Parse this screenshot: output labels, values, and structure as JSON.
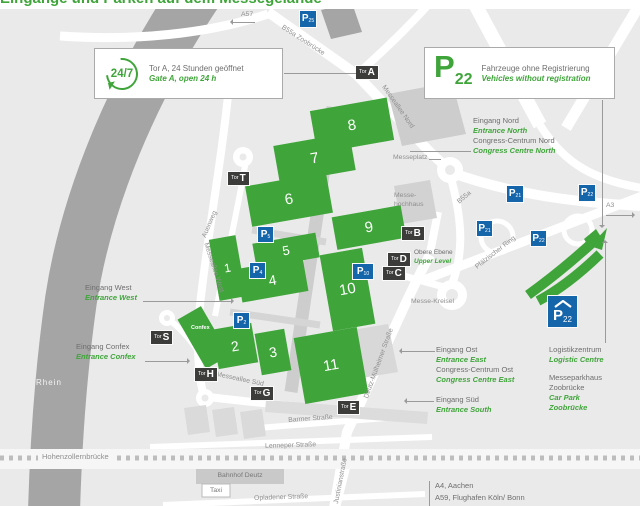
{
  "colors": {
    "green": "#3fa53a",
    "blue": "#1565ab",
    "dark_badge": "#3c3c3b",
    "map_bg": "#eaeaea",
    "river": "#a5a5a5",
    "gray_text": "#6e6e6e",
    "road_text": "#8f8f8f",
    "building": "#d5d5d5"
  },
  "heading": {
    "fragment": "Eingänge und Parken auf dem Messegelände"
  },
  "boxes": {
    "gate_a": {
      "badge": "24/7",
      "de": "Tor A, 24 Stunden geöffnet",
      "en": "Gate A, open 24 h"
    },
    "p22": {
      "p": "P",
      "sub": "22",
      "de": "Fahrzeuge ohne Registrierung",
      "en": "Vehicles without registration"
    }
  },
  "halls": {
    "h1": "1",
    "h2": "2",
    "h3": "3",
    "h4": "4",
    "h5": "5",
    "h6": "6",
    "h7": "7",
    "h8": "8",
    "h9": "9",
    "h10": "10",
    "h11": "11",
    "confex": "Confex"
  },
  "gates": {
    "prefix": "Tor",
    "a": "A",
    "t": "T",
    "b": "B",
    "d": "D",
    "c": "C",
    "s": "S",
    "h": "H",
    "g": "G",
    "e": "E"
  },
  "parking": {
    "p": "P",
    "p25": "25",
    "p21": "21",
    "p22": "22",
    "p5": "5",
    "p4": "4",
    "p2": "2",
    "p10": "10"
  },
  "entrances": {
    "west": {
      "de": "Eingang West",
      "en": "Entrance West"
    },
    "confex": {
      "de": "Eingang Confex",
      "en": "Entrance Confex"
    },
    "nord": {
      "de": "Eingang Nord",
      "en": "Entrance North",
      "de2": "Congress-Centrum Nord",
      "en2": "Congress Centre North"
    },
    "ost": {
      "de": "Eingang Ost",
      "en": "Entrance East",
      "de2": "Congress-Centrum Ost",
      "en2": "Congress Centre East"
    },
    "sued": {
      "de": "Eingang Süd",
      "en": "Entrance South"
    },
    "logistik": {
      "de": "Logistikzentrum",
      "en": "Logistic Centre"
    },
    "parkhaus": {
      "de1": "Messeparkhaus",
      "de2": "Zoobrücke",
      "en1": "Car Park",
      "en2": "Zoobrücke"
    }
  },
  "places": {
    "messeplatz": "Messeplatz",
    "hochhaus1": "Messe-",
    "hochhaus2": "hochhaus",
    "obere_de": "Obere Ebene",
    "obere_en": "Upper Level",
    "kreisel": "Messe-Kreisel",
    "rhein": "Rhein",
    "hohenzollernbruecke": "Hohenzollernbrücke",
    "bahnhof": "Bahnhof Deutz",
    "taxi": "Taxi"
  },
  "roads": {
    "a57": "A57",
    "a3": "A3",
    "b55a_zoo": "B55a Zoobrücke",
    "m_nord": "Messeallee Nord",
    "b55a": "B55a",
    "pf_ring": "Pfälzischer Ring",
    "dm_str": "Deutz-Mülheimer Straße",
    "auenweg": "Auenweg",
    "m_west": "Messeallee West",
    "m_sued": "Messeallee Süd",
    "barmer": "Barmer Straße",
    "lenneper": "Lenneper Straße",
    "opladener": "Opladener Straße",
    "justinian": "Justinianstraße"
  },
  "destinations": {
    "a4": "A4, Aachen",
    "a59": "A59, Flughafen Köln/ Bonn"
  }
}
